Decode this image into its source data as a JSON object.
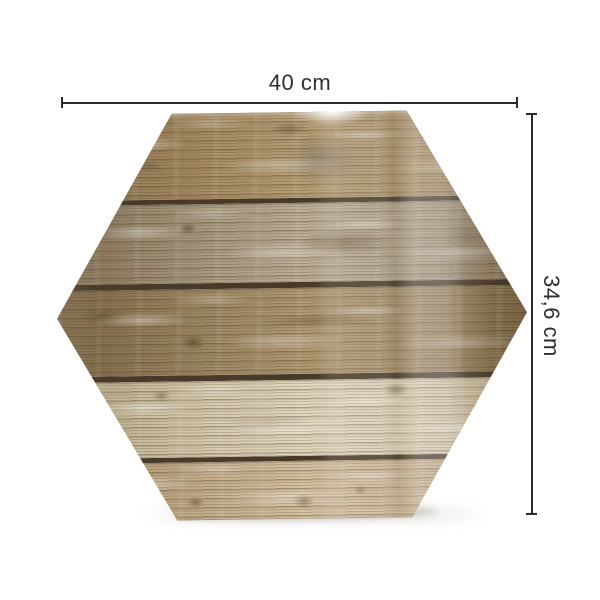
{
  "product_image": {
    "shape": "hexagon",
    "surface": "weathered wood planks, glossy finish"
  },
  "dimensions": {
    "width": {
      "label": "40 cm"
    },
    "height": {
      "label": "34,6 cm"
    }
  },
  "colors": {
    "background": "#ffffff",
    "dimension_line": "#2b2b2b",
    "label_text": "#2e2e2e",
    "plank_gap": "#473a28"
  },
  "hexagon": {
    "planks": [
      {
        "height": 86,
        "base": "#a2885f",
        "light": "#b7a077",
        "shade": "#86704e",
        "gap_below": 5,
        "knots": [
          {
            "x": 57,
            "y": 55,
            "w": 80,
            "h": 52,
            "color": "rgba(120,112,98,0.55)"
          },
          {
            "x": 50,
            "y": 20,
            "w": 40,
            "h": 14,
            "color": "rgba(90,72,48,0.45)"
          },
          {
            "x": 20,
            "y": 60,
            "w": 30,
            "h": 10,
            "color": "rgba(95,76,50,0.40)"
          }
        ]
      },
      {
        "height": 79,
        "base": "#a3947a",
        "light": "#beb098",
        "shade": "#857257",
        "gap_below": 6,
        "knots": [
          {
            "x": 62,
            "y": 50,
            "w": 100,
            "h": 26,
            "color": "rgba(104,80,52,0.50)"
          },
          {
            "x": 28,
            "y": 30,
            "w": 18,
            "h": 12,
            "color": "rgba(80,62,40,0.55)"
          },
          {
            "x": 88,
            "y": 45,
            "w": 60,
            "h": 30,
            "color": "rgba(118,104,88,0.45)"
          }
        ]
      },
      {
        "height": 86,
        "base": "#9a8460",
        "light": "#b19a72",
        "shade": "#7c6645",
        "gap_below": 6,
        "knots": [
          {
            "x": 29,
            "y": 62,
            "w": 24,
            "h": 16,
            "color": "rgba(82,64,42,0.60)"
          },
          {
            "x": 55,
            "y": 38,
            "w": 130,
            "h": 12,
            "color": "rgba(92,72,46,0.40)"
          },
          {
            "x": 10,
            "y": 30,
            "w": 40,
            "h": 18,
            "color": "rgba(88,70,46,0.45)"
          }
        ]
      },
      {
        "height": 76,
        "base": "#d2c5a8",
        "light": "#e2d7bf",
        "shade": "#b5a484",
        "gap_below": 5,
        "knots": [
          {
            "x": 22,
            "y": 18,
            "w": 20,
            "h": 13,
            "color": "rgba(112,90,62,0.50)"
          },
          {
            "x": 72,
            "y": 14,
            "w": 26,
            "h": 15,
            "color": "rgba(106,84,56,0.55)"
          },
          {
            "x": 45,
            "y": 55,
            "w": 90,
            "h": 16,
            "color": "rgba(160,142,112,0.40)"
          }
        ]
      },
      {
        "height": 59,
        "base": "#c1aa88",
        "light": "#d5c2a3",
        "shade": "#a68c69",
        "gap_below": 0,
        "knots": [
          {
            "x": 29,
            "y": 68,
            "w": 18,
            "h": 13,
            "color": "rgba(108,86,58,0.60)"
          },
          {
            "x": 52,
            "y": 68,
            "w": 22,
            "h": 15,
            "color": "rgba(98,76,50,0.60)"
          },
          {
            "x": 64,
            "y": 50,
            "w": 15,
            "h": 11,
            "color": "rgba(110,88,60,0.50)"
          },
          {
            "x": 83,
            "y": 40,
            "w": 40,
            "h": 16,
            "color": "rgba(100,84,62,0.45)"
          }
        ]
      }
    ]
  }
}
